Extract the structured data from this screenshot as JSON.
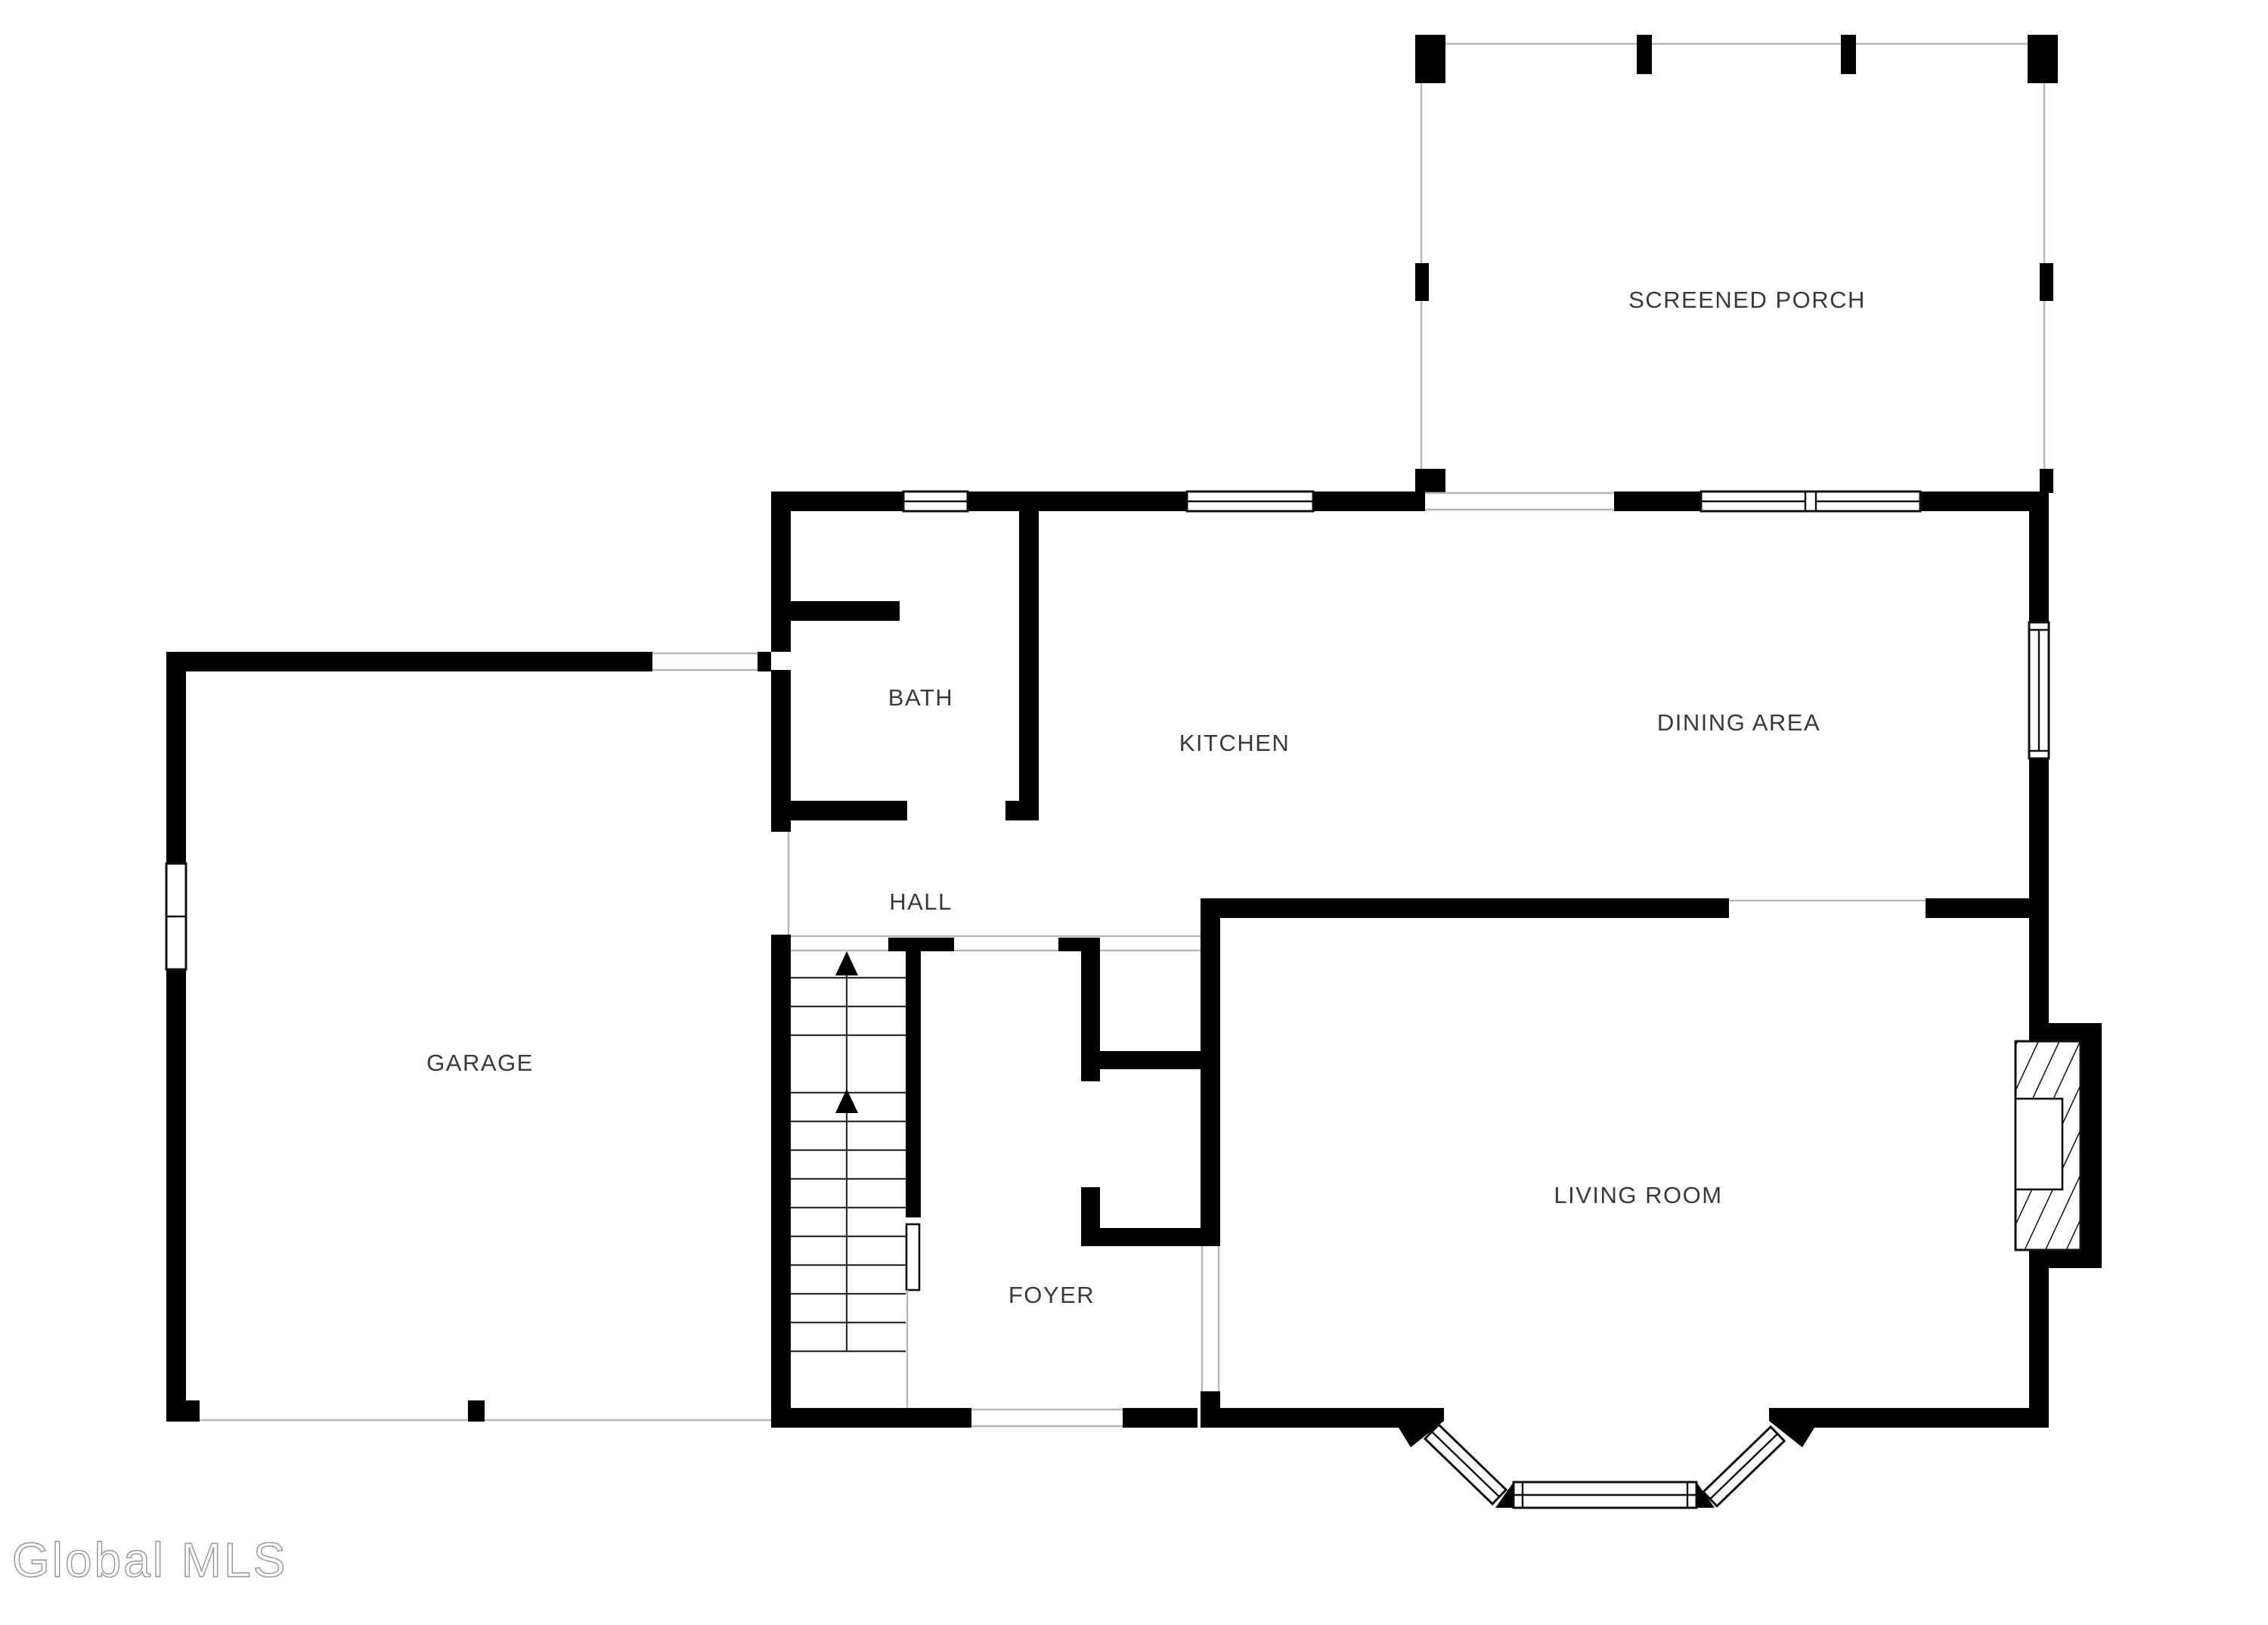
{
  "rooms": {
    "screened_porch": {
      "label": "SCREENED PORCH"
    },
    "bath": {
      "label": "BATH"
    },
    "kitchen": {
      "label": "KITCHEN"
    },
    "dining_area": {
      "label": "DINING AREA"
    },
    "garage": {
      "label": "GARAGE"
    },
    "hall": {
      "label": "HALL"
    },
    "foyer": {
      "label": "FOYER"
    },
    "living_room": {
      "label": "LIVING ROOM"
    }
  },
  "watermark": {
    "text": "Global MLS"
  },
  "stairs": {
    "direction": "up",
    "arrow_count": 2
  },
  "colors": {
    "wall": "#000000",
    "screen_line": "#b7b7b7",
    "label_text": "#3a3a3a",
    "background": "#ffffff",
    "watermark_outline": "#8f8f8f"
  }
}
